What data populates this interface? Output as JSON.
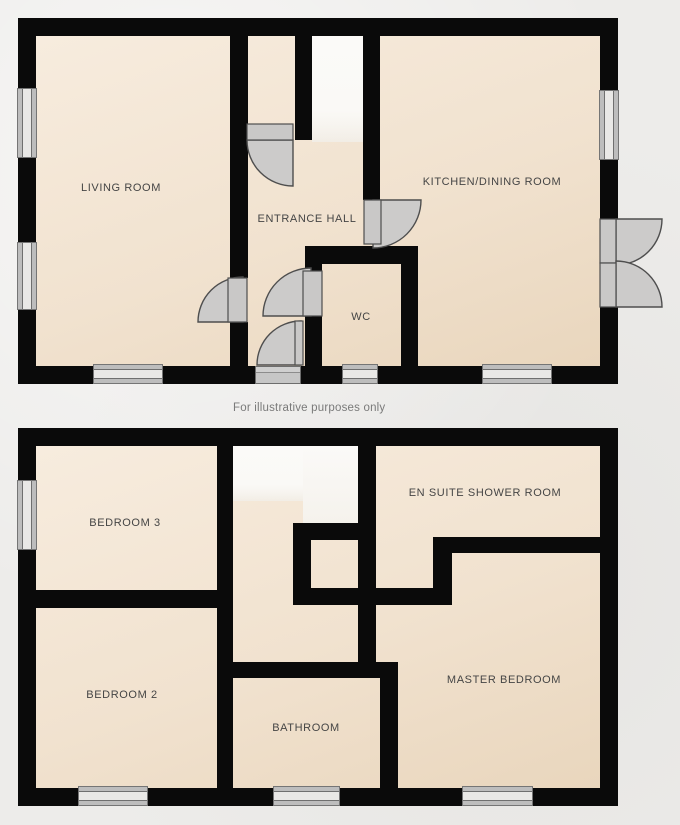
{
  "caption": "For illustrative purposes only",
  "floors": {
    "ground": {
      "rooms": {
        "living_room": "LIVING ROOM",
        "entrance_hall": "ENTRANCE HALL",
        "wc": "WC",
        "kitchen_dining": "KITCHEN/DINING ROOM"
      }
    },
    "first": {
      "rooms": {
        "bedroom3": "BEDROOM 3",
        "en_suite": "EN SUITE SHOWER ROOM",
        "bedroom2": "BEDROOM 2",
        "bathroom": "BATHROOM",
        "master_bedroom": "MASTER BEDROOM"
      }
    }
  },
  "colors": {
    "wall": "#0a0a0a",
    "room_fill": "#f1e2d0",
    "window_gray": "#c6c6c6",
    "door_gray": "#cdcdcd",
    "stairs_white": "#faf9f6",
    "background": "#edecea",
    "label_text": "#454545",
    "caption_text": "#7a7a7a"
  }
}
